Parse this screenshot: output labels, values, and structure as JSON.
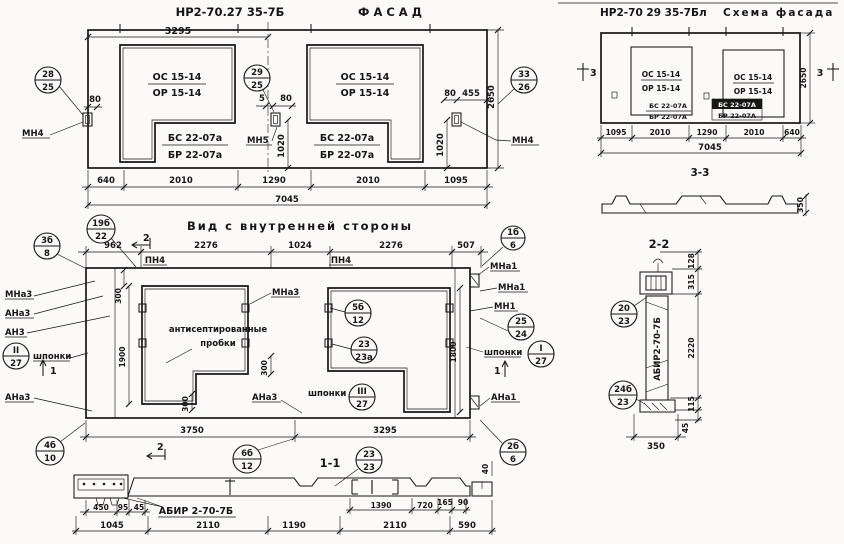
{
  "facade": {
    "title_code": "НР2-70.27 35-7Б",
    "title_name": "ФАСАД",
    "dim_width_half": "3295",
    "win_top": "ОС 15-14",
    "win_bot": "ОР 15-14",
    "sill_top": "БС 22-07а",
    "sill_bot": "БР 22-07а",
    "balloon_left": {
      "top": "28",
      "bot": "25"
    },
    "balloon_mid": {
      "top": "29",
      "bot": "25"
    },
    "balloon_right": {
      "top": "33",
      "bot": "26"
    },
    "anchor_left": "МН4",
    "anchor_mid": "МН5",
    "anchor_right": "МН4",
    "d80": "80",
    "d5": "5",
    "d455": "455",
    "v1020": "1020",
    "height": "2650",
    "dims_row": [
      "640",
      "2010",
      "1290",
      "2010",
      "1095"
    ],
    "dim_total": "7045"
  },
  "scheme": {
    "title_code": "НР2-70 29 35-7Бл",
    "title_name": "Схема фасада",
    "win_top": "ОС 15-14",
    "win_bot": "ОР 15-14",
    "sill_top": "БС 22-07А",
    "sill_bot": "БР 22-07А",
    "marker": "3",
    "height": "2650",
    "dims_row": [
      "1095",
      "2010",
      "1290",
      "2010",
      "640"
    ],
    "dim_total": "7045",
    "section_title": "3-3",
    "thickness": "350"
  },
  "interior": {
    "title": "Вид с внутренней стороны",
    "dims_top": [
      "962",
      "2276",
      "1024",
      "2276",
      "507"
    ],
    "pn4": "ПН4",
    "note_line1": "антисептированные",
    "note_line2": "пробки",
    "shponki": "шпонки",
    "labels": {
      "mna3": "МНа3",
      "ana3": "АНа3",
      "an3": "АН3",
      "mna1": "МНа1",
      "mn1": "МН1",
      "ana1": "АНа1"
    },
    "marker1": "1",
    "marker2": "2",
    "balloons": {
      "b19": {
        "top": "19б",
        "bot": "22"
      },
      "b3": {
        "top": "3б",
        "bot": "8"
      },
      "bII": {
        "top": "II",
        "bot": "27"
      },
      "b4": {
        "top": "4б",
        "bot": "10"
      },
      "b1": {
        "top": "1б",
        "bot": "6"
      },
      "b25": {
        "top": "25",
        "bot": "24"
      },
      "bI": {
        "top": "I",
        "bot": "27"
      },
      "b2": {
        "top": "2б",
        "bot": "6"
      },
      "b5": {
        "top": "5б",
        "bot": "12"
      },
      "b23a": {
        "top": "23",
        "bot": "23а"
      },
      "bIII": {
        "top": "III",
        "bot": "27"
      },
      "b6": {
        "top": "6б",
        "bot": "12"
      },
      "b23": {
        "top": "23",
        "bot": "23"
      }
    },
    "v300": "300",
    "v1900": "1900",
    "v1800": "1800",
    "v40": "40",
    "dims_bottom": [
      "3750",
      "3295"
    ],
    "section_title": "1-1"
  },
  "section11": {
    "label": "АБИР 2-70-7Б",
    "dims_left": [
      "450",
      "95",
      "45"
    ],
    "dims_right": [
      "1390",
      "720",
      "165",
      "90"
    ],
    "dims_row2": [
      "1045",
      "2110",
      "1190",
      "2110",
      "590"
    ]
  },
  "section22": {
    "title": "2-2",
    "label": "АБИР2-70-7Б",
    "d128": "128",
    "d315": "315",
    "d2220": "2220",
    "d115": "115",
    "d45": "45",
    "d350": "350",
    "balloon_top": {
      "top": "20",
      "bot": "23"
    },
    "balloon_bot": {
      "top": "24б",
      "bot": "23"
    }
  }
}
